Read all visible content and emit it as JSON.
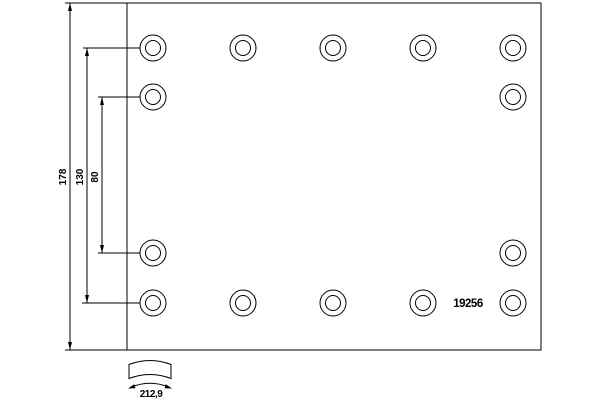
{
  "drawing": {
    "part_number": "19256",
    "dimensions": {
      "total_height": "178",
      "hole_span_outer": "130",
      "hole_span_inner": "80",
      "arc_width": "212,9"
    },
    "colors": {
      "line": "#000000",
      "background": "#ffffff"
    },
    "description": "brake-lining-technical-drawing",
    "hole_count": 14
  }
}
